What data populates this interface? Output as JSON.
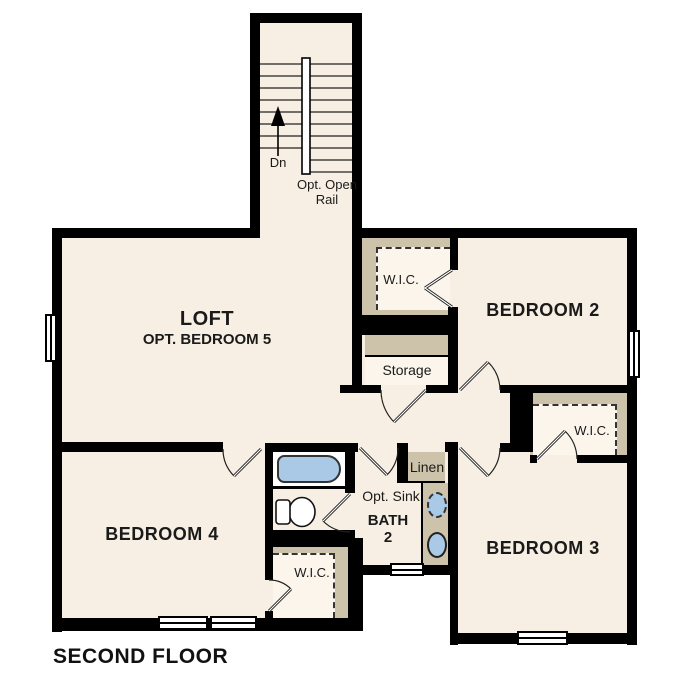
{
  "floor_name": "SECOND FLOOR",
  "stairwell": {
    "direction_label": "Dn",
    "rail_note": [
      "Opt. Open",
      "Rail"
    ]
  },
  "rooms": {
    "loft": {
      "label": "LOFT",
      "option_label": "OPT. BEDROOM 5"
    },
    "bedroom2": {
      "label": "BEDROOM 2",
      "closet_label": "W.I.C."
    },
    "bedroom3": {
      "label": "BEDROOM 3",
      "closet_label": "W.I.C."
    },
    "bedroom4": {
      "label": "BEDROOM 4",
      "closet_label": "W.I.C."
    },
    "bath2": {
      "label_line1": "BATH",
      "label_line2": "2",
      "option_label": "Opt. Sink"
    },
    "storage": {
      "label": "Storage"
    },
    "linen": {
      "label": "Linen"
    }
  },
  "colors": {
    "floor": "#f7efe3",
    "shelving": "#cdc3ab",
    "wall": "#000000",
    "fixture_blue": "#a9c9e6"
  }
}
